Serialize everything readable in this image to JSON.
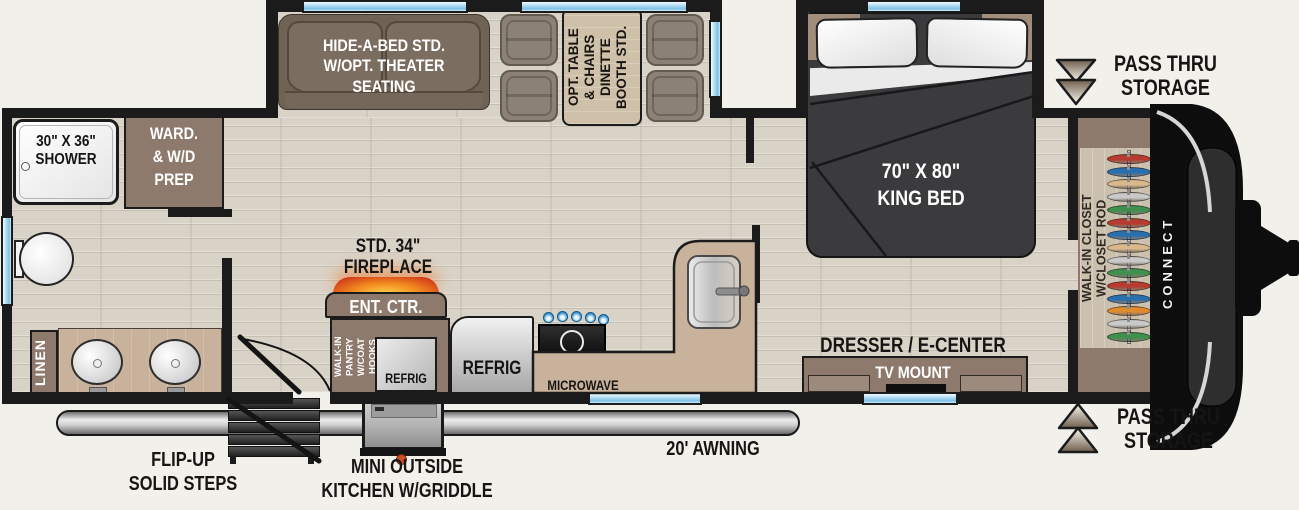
{
  "title": "Travel trailer floor plan",
  "brand": "CONNECT",
  "colors": {
    "wall": "#1b1b1b",
    "floor_wood": "#d9d3c7",
    "cabinet_brown": "#8d7a6c",
    "counter_tan": "#c8b29c",
    "window_blue": "#7cc0e4",
    "sofa_taupe": "#7b6e60",
    "bed_dark": "#3b3b3d",
    "fireplace_orange": "#e8611c",
    "awning_gray": "#bdbdbd",
    "arrow_brown": "#6f5f4d"
  },
  "labels": {
    "shower": {
      "line1": "30\" X 36\"",
      "line2": "SHOWER"
    },
    "wardrobe": {
      "line1": "WARD.",
      "line2": "& W/D",
      "line3": "PREP"
    },
    "hide_a_bed": {
      "line1": "HIDE-A-BED STD.",
      "line2": "W/OPT. THEATER",
      "line3": "SEATING"
    },
    "dinette": {
      "line1": "OPT. TABLE",
      "line2": "& CHAIRS",
      "line3": "DINETTE",
      "line4": "BOOTH STD."
    },
    "king_bed": {
      "line1": "70\" X 80\"",
      "line2": "KING BED"
    },
    "pass_thru_top": {
      "line1": "PASS THRU",
      "line2": "STORAGE"
    },
    "pass_thru_bottom": {
      "line1": "PASS THRU",
      "line2": "STORAGE"
    },
    "walk_in_closet": {
      "line1": "WALK-IN CLOSET",
      "line2": "W/CLOSET ROD"
    },
    "fireplace": {
      "line1": "STD. 34\"",
      "line2": "FIREPLACE"
    },
    "ent_ctr": "ENT. CTR.",
    "pantry": {
      "line1": "WALK-IN PANTRY",
      "line2": "W/COAT HOOKS"
    },
    "refrig_small": "REFRIG",
    "refrig_large": "REFRIG",
    "microwave": "MICROWAVE",
    "linen": "LINEN",
    "dresser": "DRESSER / E-CENTER",
    "tv_mount": "TV MOUNT",
    "awning": "20' AWNING",
    "steps": {
      "line1": "FLIP-UP",
      "line2": "SOLID STEPS"
    },
    "outside_kitchen": {
      "line1": "MINI OUTSIDE",
      "line2": "KITCHEN W/GRIDDLE"
    }
  },
  "closet": {
    "hanger_colors": [
      "#b73b2e",
      "#2a6fad",
      "#d9b98c",
      "#c9c9c9",
      "#3f8f4f",
      "#b73b2e",
      "#2a6fad",
      "#d9b98c",
      "#c9c9c9",
      "#3f8f4f",
      "#b73b2e",
      "#2a6fad",
      "#e08b2d",
      "#c9c9c9",
      "#3f8f4f"
    ]
  }
}
